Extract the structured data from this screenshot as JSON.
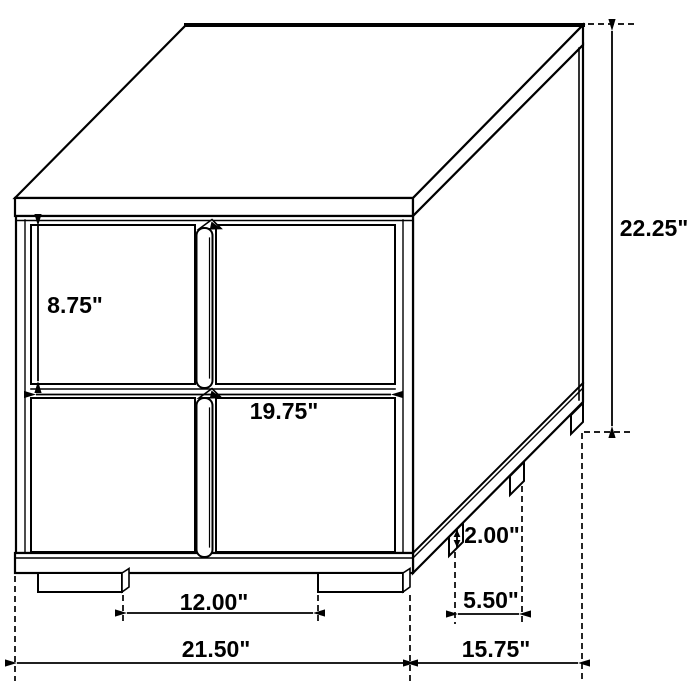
{
  "diagram": {
    "type": "furniture-dimension-drawing",
    "subject": "2-drawer nightstand line drawing",
    "unit": "inches",
    "dimensions": {
      "overall_height": "22.25\"",
      "overall_width": "21.50\"",
      "overall_depth": "15.75\"",
      "drawer_height": "8.75\"",
      "drawer_width": "19.75\"",
      "leg_height": "2.00\"",
      "leg_spacing_front": "12.00\"",
      "leg_spacing_side": "5.50\""
    },
    "colors": {
      "line": "#000000",
      "background": "#ffffff"
    }
  }
}
